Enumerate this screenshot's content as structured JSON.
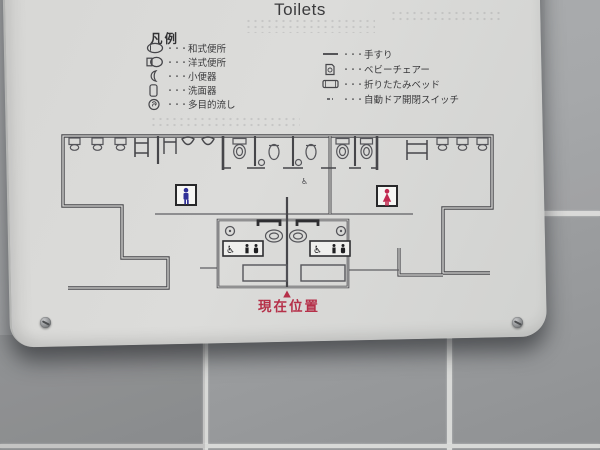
{
  "sign": {
    "title": "Toilets",
    "legend": {
      "heading": "凡例",
      "dots": "・・・",
      "left": [
        {
          "icon": "squat-toilet-icon",
          "label": "和式便所"
        },
        {
          "icon": "western-toilet-icon",
          "label": "洋式便所"
        },
        {
          "icon": "urinal-icon",
          "label": "小便器"
        },
        {
          "icon": "washbasin-icon",
          "label": "洗面器"
        },
        {
          "icon": "multipurpose-sink-icon",
          "label": "多目的流し"
        }
      ],
      "right": [
        {
          "icon": "handrail-icon",
          "label": "手すり"
        },
        {
          "icon": "baby-chair-icon",
          "label": "ベビーチェアー"
        },
        {
          "icon": "folding-bed-icon",
          "label": "折りたたみベッド"
        },
        {
          "icon": "auto-door-switch-icon",
          "label": "自動ドア開閉スイッチ"
        }
      ]
    },
    "floor_plan": {
      "current_location_label": "現在位置",
      "rooms": [
        "men",
        "women",
        "multipurpose-left",
        "multipurpose-right"
      ]
    },
    "colors": {
      "men_blue": "#2f2f97",
      "women_red": "#c22950",
      "location_red": "#b53049",
      "plan_line": "#46464a"
    }
  }
}
